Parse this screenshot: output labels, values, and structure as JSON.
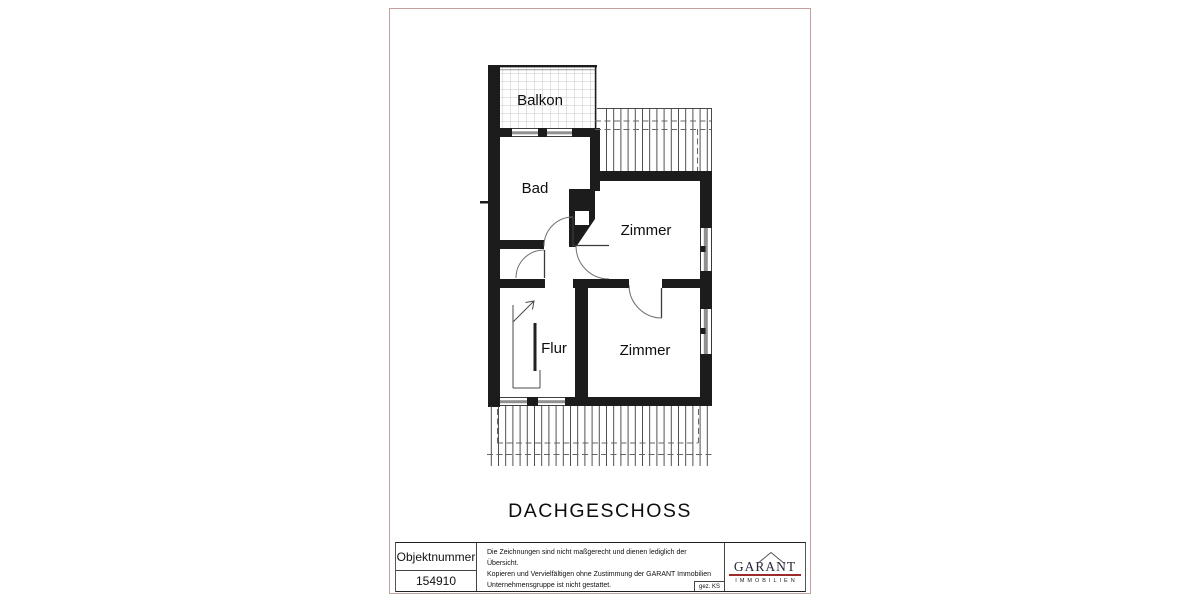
{
  "page": {
    "background": "#ffffff",
    "border_color": "#c2a0a0"
  },
  "plan": {
    "floor_title": "DACHGESCHOSS",
    "rooms": {
      "balcony": "Balkon",
      "bath": "Bad",
      "room_top": "Zimmer",
      "room_bottom": "Zimmer",
      "hall": "Flur"
    },
    "colors": {
      "wall": "#1c1c1c",
      "door_arc": "#6f6f6f",
      "window": "#909090",
      "hatch_line": "#3d3d3d",
      "tile_line": "#c6c6c6",
      "dashed_line": "#666666"
    }
  },
  "title_block": {
    "object_number_label": "Objektnummer",
    "object_number_value": "154910",
    "disclaimer_lines": [
      "Die Zeichnungen sind nicht maßgerecht und dienen lediglich der Übersicht.",
      "Kopieren und Vervielfältigen ohne Zustimmung der GARANT Immobilien",
      "Unternehmensgruppe ist nicht gestattet."
    ],
    "drawn_by": "gez. KS",
    "logo": {
      "brand": "GARANT",
      "subtitle": "IMMOBILIEN",
      "rule_color": "#9c2b2b",
      "text_color": "#26263a"
    }
  }
}
